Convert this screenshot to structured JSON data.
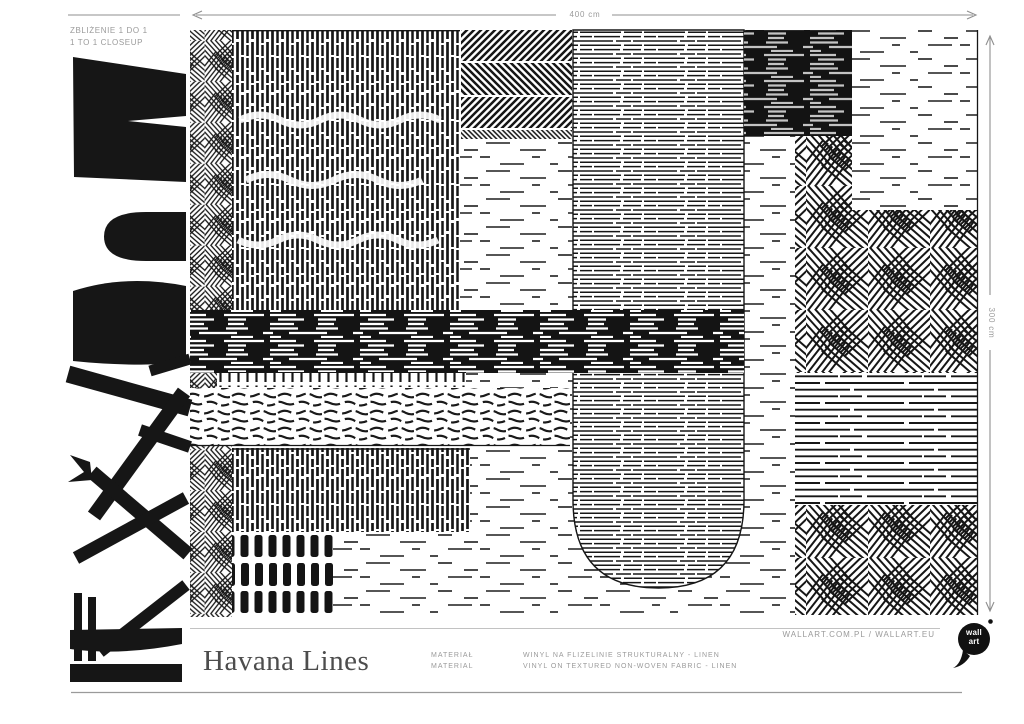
{
  "closeup": {
    "line1": "ZBLIŻENIE 1 DO 1",
    "line2": "1 TO 1 CLOSEUP"
  },
  "dimensions": {
    "width": "400 cm",
    "height": "300 cm"
  },
  "product": {
    "title": "Havana Lines"
  },
  "material": {
    "label_pl": "MATERIAŁ",
    "label_en": "MATERIAL",
    "value_pl": "WINYL NA FLIZELINIE STRUKTURALNY - LINEN",
    "value_en": "VINYL ON TEXTURED NON-WOVEN FABRIC - LINEN"
  },
  "footer": {
    "websites": "WALLART.COM.PL / WALLART.EU"
  },
  "logo": {
    "line1": "wall",
    "line2": "art"
  },
  "colors": {
    "ink": "#161616",
    "label_gray": "#9a9a9a",
    "title_gray": "#4d4d4d",
    "rule_gray": "#b5b5b5"
  }
}
